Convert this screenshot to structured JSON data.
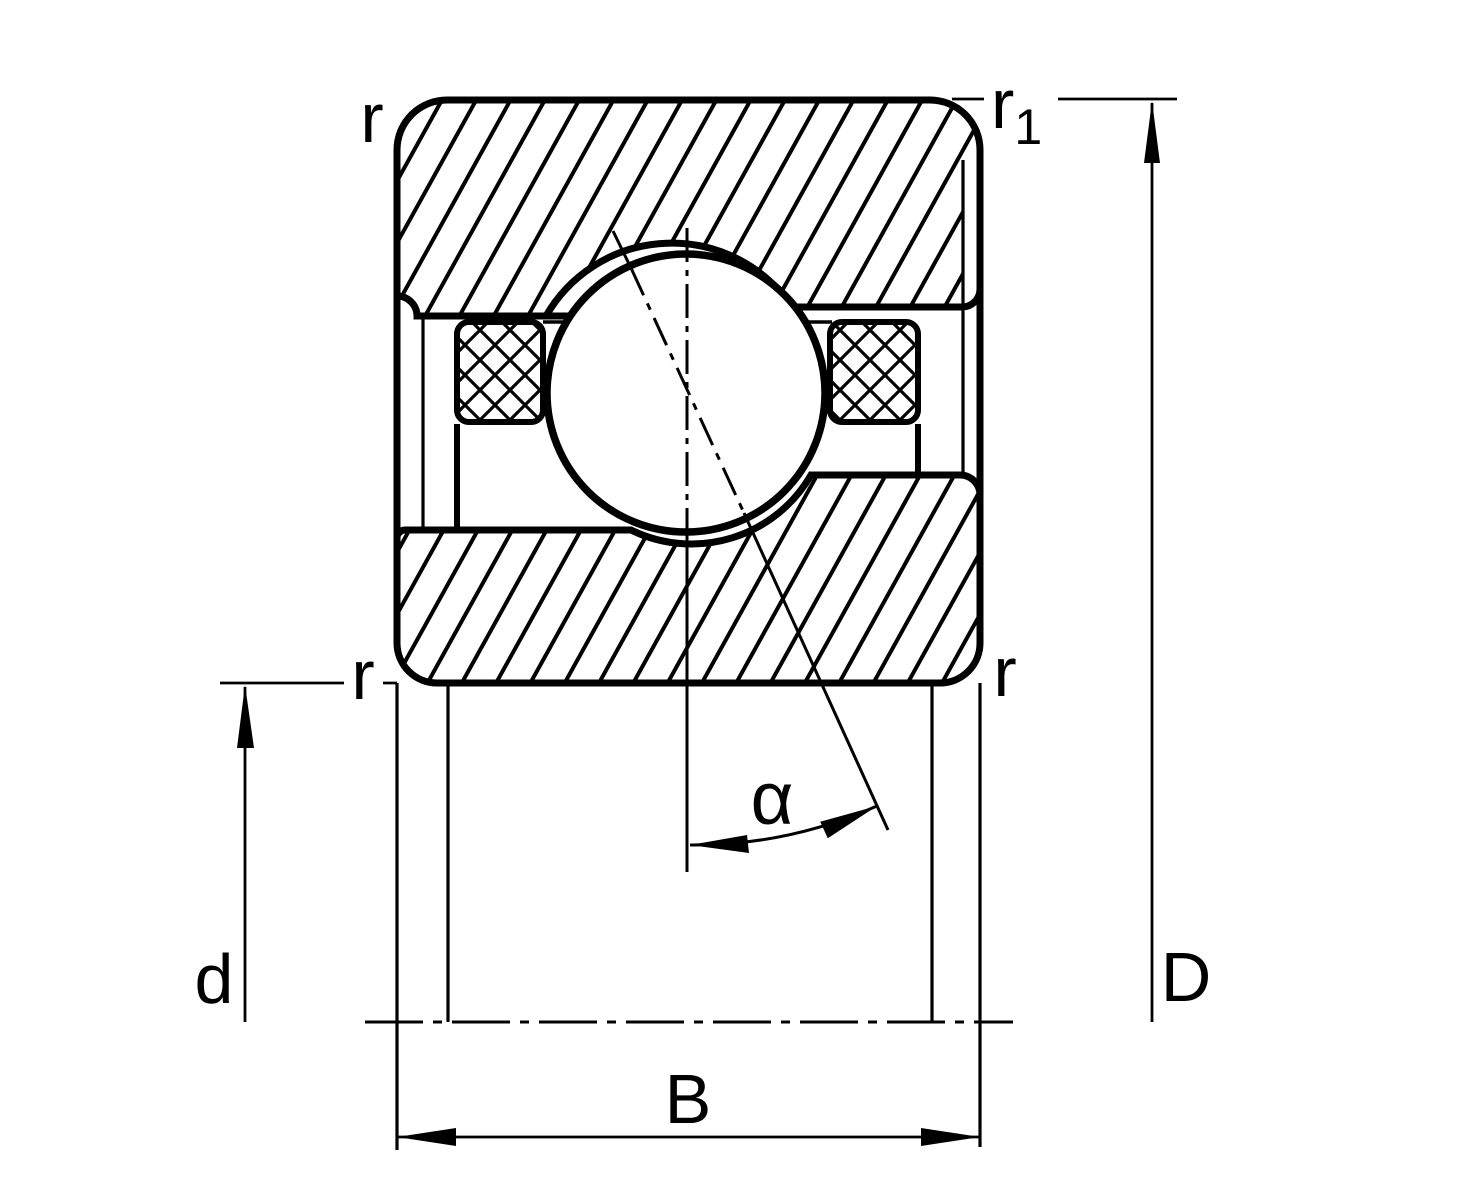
{
  "drawing": {
    "title": "angular-contact-ball-bearing-cross-section",
    "colors": {
      "line": "#000000",
      "background": "#ffffff"
    },
    "labels": {
      "radius_top_left": "r",
      "radius_top_right_base": "r",
      "radius_top_right_sub": "1",
      "radius_bottom_left": "r",
      "radius_bottom_right": "r",
      "bore_diameter": "d",
      "outer_diameter": "D",
      "width": "B",
      "contact_angle": "α"
    }
  }
}
